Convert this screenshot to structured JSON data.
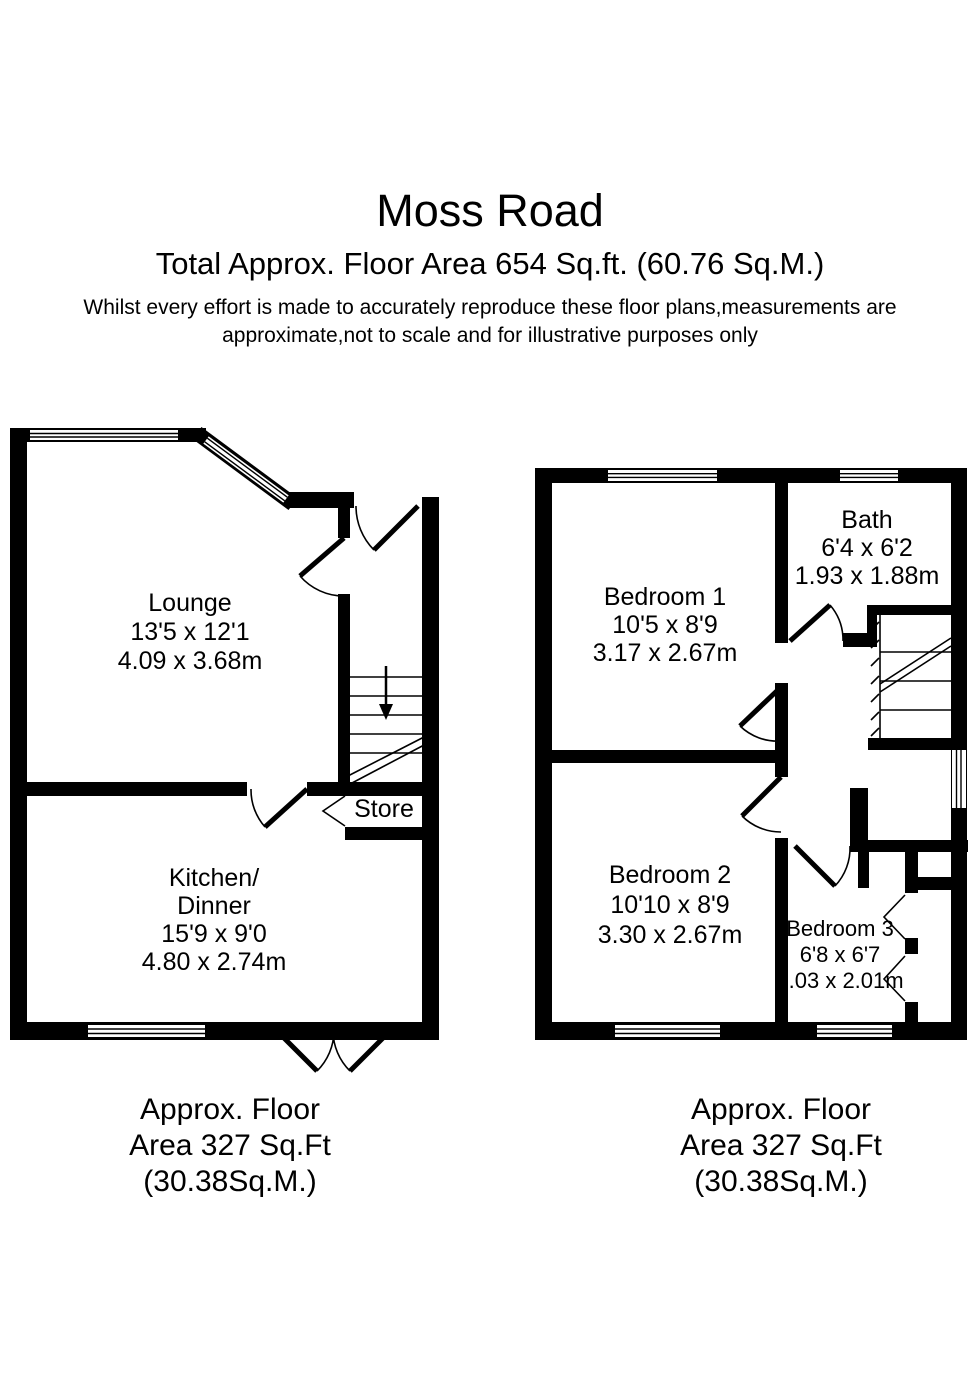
{
  "colors": {
    "wall": "#000000",
    "background": "#ffffff",
    "text": "#000000"
  },
  "header": {
    "title": "Moss Road",
    "subtitle": "Total Approx. Floor Area 654 Sq.ft. (60.76 Sq.M.)",
    "disclaimer_line1": "Whilst every effort is made to accurately reproduce these floor plans,measurements are",
    "disclaimer_line2": "approximate,not to scale and for illustrative purposes only"
  },
  "ground_floor": {
    "rooms": {
      "lounge": {
        "name": "Lounge",
        "size_imperial": "13'5 x 12'1",
        "size_metric": "4.09 x 3.68m"
      },
      "kitchen": {
        "name_line1": "Kitchen/",
        "name_line2": "Dinner",
        "size_imperial": "15'9 x 9'0",
        "size_metric": "4.80 x 2.74m"
      },
      "store": {
        "name": "Store"
      }
    },
    "caption": {
      "line1": "Approx. Floor",
      "line2": "Area 327 Sq.Ft",
      "line3": "(30.38Sq.M.)"
    }
  },
  "first_floor": {
    "rooms": {
      "bedroom1": {
        "name": "Bedroom 1",
        "size_imperial": "10'5 x 8'9",
        "size_metric": "3.17 x 2.67m"
      },
      "bath": {
        "name": "Bath",
        "size_imperial": "6'4 x 6'2",
        "size_metric": "1.93 x 1.88m"
      },
      "bedroom2": {
        "name": "Bedroom 2",
        "size_imperial": "10'10 x 8'9",
        "size_metric": "3.30 x 2.67m"
      },
      "bedroom3": {
        "name": "Bedroom 3",
        "size_imperial": "6'8 x 6'7",
        "size_metric": "2.03 x 2.01m"
      }
    },
    "caption": {
      "line1": "Approx. Floor",
      "line2": "Area 327 Sq.Ft",
      "line3": "(30.38Sq.M.)"
    }
  }
}
